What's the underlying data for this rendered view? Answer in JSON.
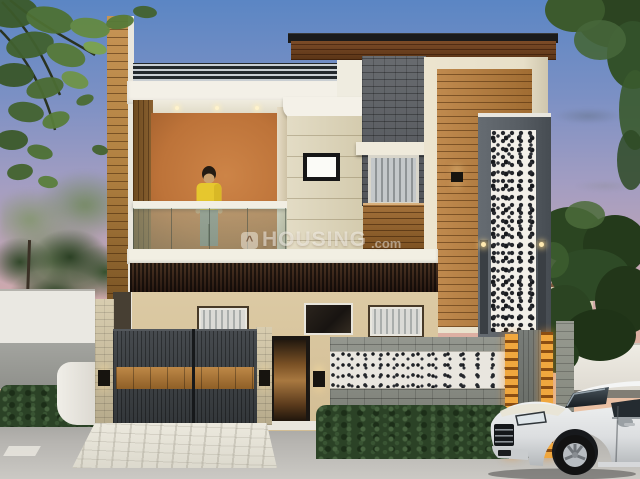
{
  "scene": {
    "type": "3d-architectural-render",
    "description": "Exterior render of a modern two-storey house at dusk: wooden and stone facade, open first-floor balcony with a person in a yellow shirt, charcoal entrance gate, perforated jali feature column, hedges, paved driveway and a white SUV parked at the street",
    "watermark": {
      "icon_glyph": "^",
      "brand": "HOUSING",
      "suffix": ".com"
    }
  },
  "palette": {
    "sky_top": "#5b86c4",
    "sky_horizon": "#f3d4b2",
    "facade_white": "#f3f0e7",
    "balcony_terracotta": "#bd7339",
    "timber": "#b9854a",
    "cream_stone": "#ddd5bd",
    "slate_stone": "#55585c",
    "jali_gray": "#585e64",
    "jali_white": "#f3f0e9",
    "ground_beige": "#d8c5a0",
    "gate_charcoal": "#383d40",
    "gate_wood": "#ad7a3e",
    "hedge_green": "#2b4226",
    "stone_wall_gray": "#8b8e86",
    "orange_pillar": "#e09532",
    "road_gray": "#b6b4b0",
    "car_silver": "#e6e8e9",
    "shirt_yellow": "#e6c72e"
  }
}
